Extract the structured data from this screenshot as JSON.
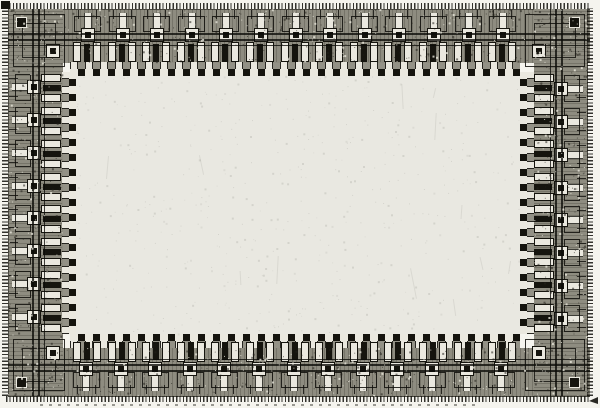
{
  "meta": {
    "description": "Black-and-white photomicrograph of an integrated-circuit die: a rectangular perimeter ring of bond-pad I/O cells with wire loops, bright metal bars and dark contact blocks, a fine tick fringe along the die edges, and an empty unpatterned light-gray core area in the center. No text is visible.",
    "subject": "ic-die-photomicrograph"
  },
  "die": {
    "pad_cells": {
      "top": 13,
      "bottom": 13,
      "left": 8,
      "right": 8
    },
    "corner_cells": [
      "top-left",
      "top-right",
      "bottom-left",
      "bottom-right"
    ],
    "bus_lines_per_edge": 3,
    "colors": {
      "paper": "#f5f4ee",
      "core": "#e9e8e1",
      "ring_base": "#8e8c80",
      "dark": "#15140e",
      "metal_light": "#eae8df",
      "speck_dark": "#23221b",
      "speck_light": "#e8e6db"
    }
  }
}
